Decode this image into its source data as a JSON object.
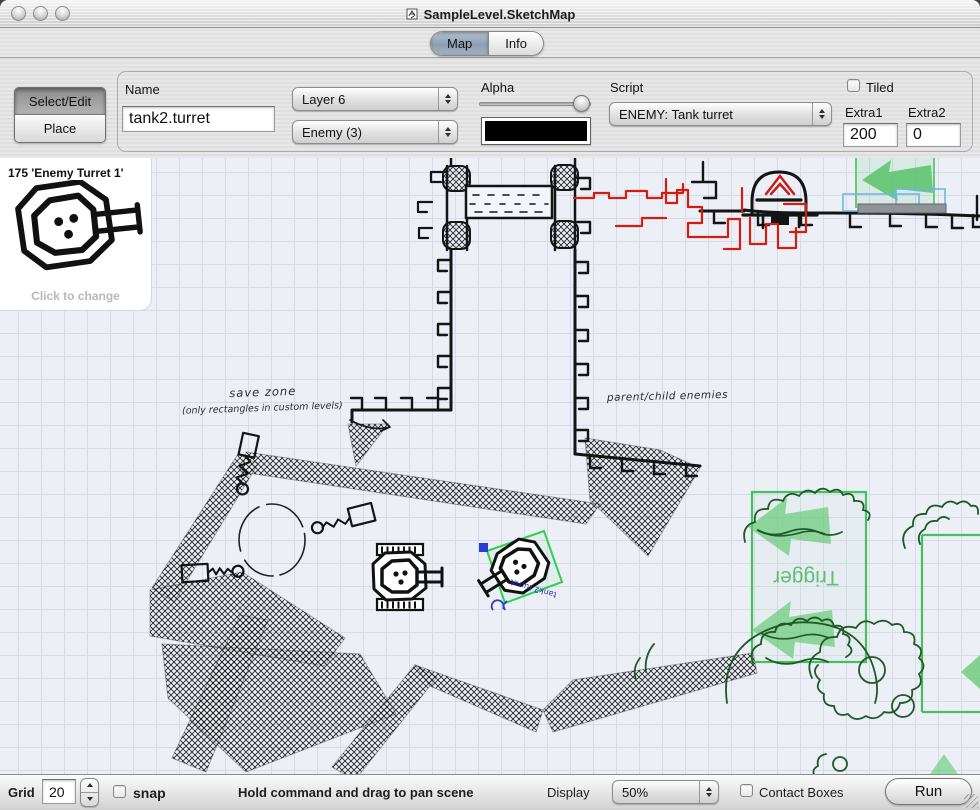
{
  "window": {
    "title": "SampleLevel.SketchMap"
  },
  "tabs": {
    "map": "Map",
    "info": "Info"
  },
  "toolbar": {
    "select_edit": "Select/Edit",
    "place": "Place",
    "name_label": "Name",
    "name_value": "tank2.turret",
    "layer_value": "Layer 6",
    "category_value": "Enemy (3)",
    "alpha_label": "Alpha",
    "swatch_color": "#000000",
    "script_label": "Script",
    "script_value": "ENEMY: Tank turret",
    "tiled_label": "Tiled",
    "extra1_label": "Extra1",
    "extra1_value": "200",
    "extra2_label": "Extra2",
    "extra2_value": "0"
  },
  "preview": {
    "title": "175 'Enemy Turret 1'",
    "hint": "Click to change"
  },
  "canvas": {
    "annotations": {
      "save_zone_line1": "save zone",
      "save_zone_line2": "(only rectangles in custom levels)",
      "enemies_note": "parent/child enemies",
      "trigger_label": "Trigger",
      "selected_object_label": "tank2.turret"
    },
    "colors": {
      "ink": "#141414",
      "red_route": "#d01f10",
      "trigger_green": "#46c05e",
      "bush_green": "#1e5a28",
      "selection_green": "#2fd04c",
      "handle_blue": "#2b3bd6",
      "paper": "#edeff7",
      "grid": "#d7dbe8"
    }
  },
  "statusbar": {
    "grid_label": "Grid",
    "grid_value": "20",
    "snap_label": "snap",
    "hint": "Hold command and drag to pan scene",
    "display_label": "Display",
    "display_value": "50%",
    "contact_boxes_label": "Contact Boxes",
    "run_label": "Run"
  }
}
